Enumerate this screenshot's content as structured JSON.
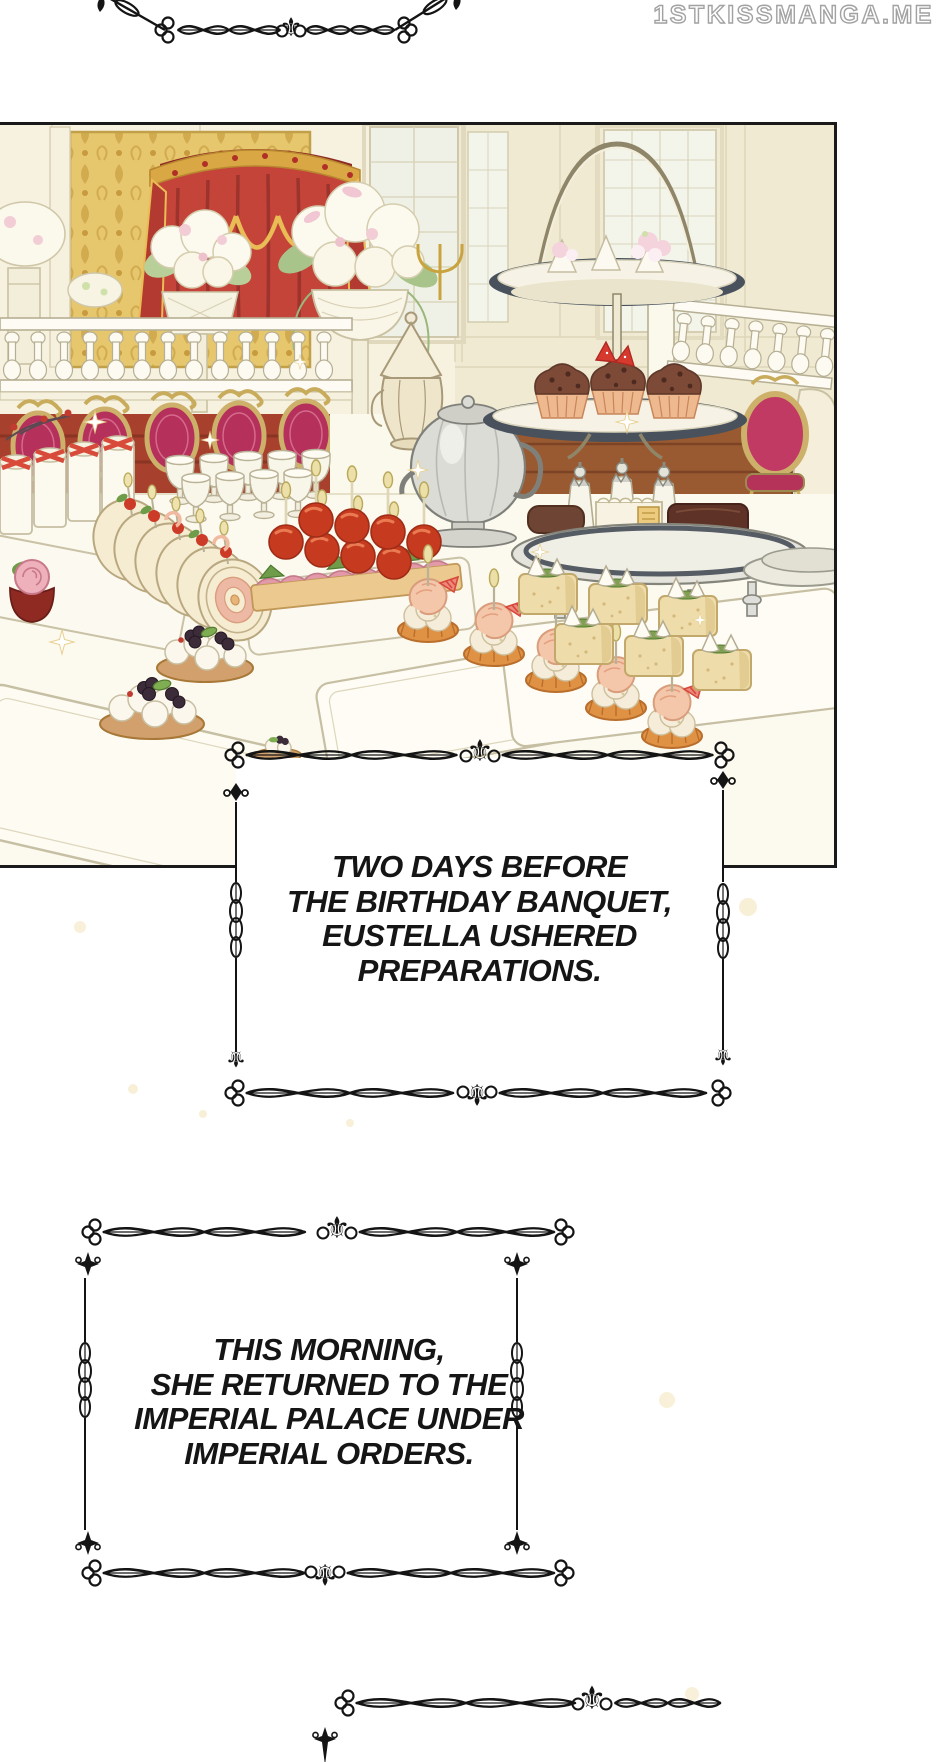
{
  "watermark": {
    "text": "1STKISSMANGA.ME"
  },
  "illustration": {
    "alt": "Lavish palace banquet hall: gold damask wall, red canopy with gold-trimmed swags, tall windows, white balustrades, gold-framed magenta chairs, white flower arrangements, silver samovar and ivory coffee pot, tiered stand with chocolate cupcakes and strawberries, trays of canapes, tomato skewers, shrimp tartlets, meringue-topped cakes and cream berry tarts"
  },
  "captions": [
    {
      "id": "caption-1",
      "lines": [
        "TWO DAYS BEFORE",
        "THE BIRTHDAY BANQUET,",
        "EUSTELLA USHERED",
        "PREPARATIONS."
      ]
    },
    {
      "id": "caption-2",
      "lines": [
        "THIS MORNING,",
        "SHE RETURNED TO THE",
        "IMPERIAL PALACE UNDER",
        "IMPERIAL ORDERS."
      ]
    }
  ],
  "ornaments": {
    "fleur_glyph": "⚜"
  },
  "colors": {
    "page_bg": "#ffffff",
    "ink": "#141414",
    "panel_border": "#1a1a1a",
    "wall_cream": "#f7f2e0",
    "damask_gold": "#e6c76d",
    "curtain_red": "#c5443a",
    "curtain_trim_gold": "#e9bc55",
    "chair_magenta": "#b5305a",
    "wood_brown": "#9a5a31",
    "silver": "#dcdcd6",
    "cupcake_chocolate": "#7c4a36",
    "shrimp_salmon": "#f4c6aa",
    "tomato_red": "#c63b1f",
    "sparkle_gold": "#f3e3b8"
  }
}
